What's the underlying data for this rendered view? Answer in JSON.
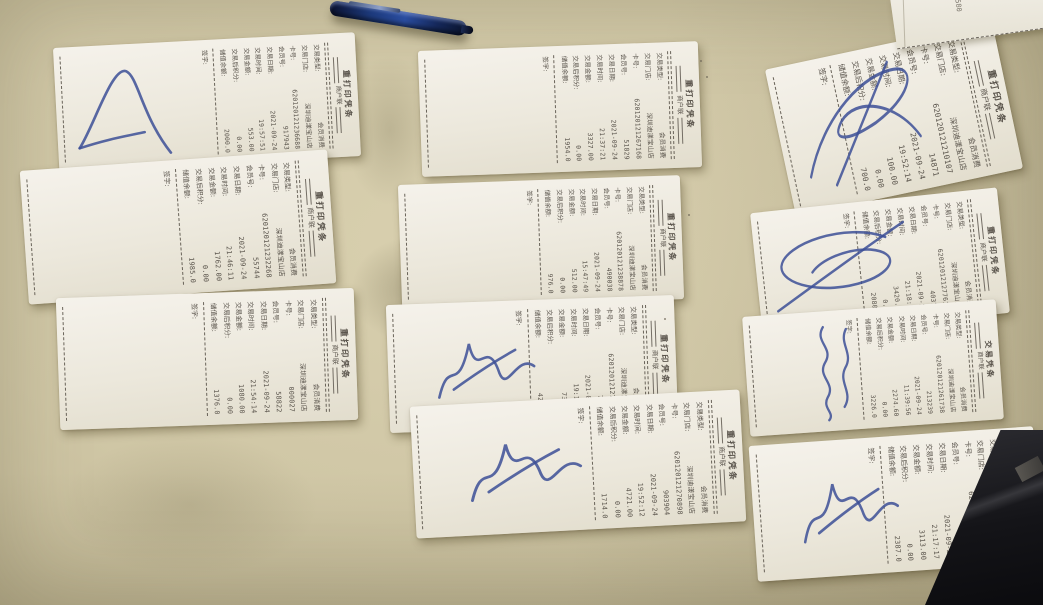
{
  "field_labels": [
    "交易类型:",
    "交易门店:",
    "卡号:",
    "会员号:",
    "交易日期:",
    "交易时间:",
    "交易金额:",
    "交易后积分:",
    "储值余额:"
  ],
  "sign_label": "签字:",
  "partial_receipt": {
    "text": "1580"
  },
  "colors": {
    "table": "#cfc6a5",
    "paper": "#f2efe7",
    "ink": "#4e4840",
    "pen_ink_blue": "#3c4f96",
    "pen_body_blue": "#1d3a7c",
    "dark_object": "#141418"
  },
  "receipts": [
    {
      "title": "重打印凭条",
      "copy_label": "商户联",
      "signature": "checkmark-scribble",
      "values": {
        "type": "会员消费",
        "store": "深圳迪漾宝山店",
        "card": "620120121236688",
        "member": "917943",
        "date": "2021-09-24",
        "time": "19:57:51",
        "amount": "553.00",
        "points": "0.00",
        "balance": "2000.0"
      }
    },
    {
      "title": "重打印凭条",
      "copy_label": "商户联",
      "signature": "none",
      "values": {
        "type": "会员消费",
        "store": "深圳迪漾宝山店",
        "card": "620120121267168",
        "member": "51829",
        "date": "2021-09-24",
        "time": "21:37:21",
        "amount": "3327.00",
        "points": "0.00",
        "balance": "1954.0"
      }
    },
    {
      "title": "重打印凭条",
      "copy_label": "商户联",
      "signature": "grand-loop-scribble",
      "values": {
        "type": "会员消费",
        "store": "深圳迪漾宝山店",
        "card": "620120121210107",
        "member": "14871",
        "date": "2021-09-24",
        "time": "19:52:14",
        "amount": "100.00",
        "points": "0.00",
        "balance": "700.0"
      }
    },
    {
      "title": "重打印凭条",
      "copy_label": "商户联",
      "signature": "none",
      "values": {
        "type": "会员消费",
        "store": "深圳迪漾宝山店",
        "card": "620120121232268",
        "member": "55744",
        "date": "2021-09-24",
        "time": "21:46:11",
        "amount": "1762.00",
        "points": "0.00",
        "balance": "1985.0"
      }
    },
    {
      "title": "重打印凭条",
      "copy_label": "商户联",
      "signature": "none",
      "values": {
        "type": "会员消费",
        "store": "深圳迪漾宝山店",
        "card": "620120121238878",
        "member": "490038",
        "date": "2021-09-24",
        "time": "15:47:49",
        "amount": "512.00",
        "points": "0.00",
        "balance": "976.0"
      }
    },
    {
      "title": "重打印凭条",
      "copy_label": "商户联",
      "signature": "oval-loop-scribble",
      "values": {
        "type": "会员消费",
        "store": "深圳迪漾宝山店",
        "card": "620120121277618",
        "member": "40379",
        "date": "2021-09-24",
        "time": "21:18:50",
        "amount": "3420.00",
        "points": "0.00",
        "balance": "2080.0"
      }
    },
    {
      "title": "重打印凭条",
      "copy_label": "商户联",
      "signature": "none",
      "values": {
        "type": "会员消费",
        "store": "深圳迪漾宝山店",
        "card": "000027",
        "member": "58822",
        "date": "2021-09-24",
        "time": "21:54:14",
        "amount": "1080.00",
        "points": "0.00",
        "balance": "1376.0"
      }
    },
    {
      "title": "重打印凭条",
      "copy_label": "商户联",
      "signature": "small-scrawl",
      "values": {
        "type": "会员消费",
        "store": "深圳迪漾宝山店",
        "card": "620120121277818",
        "member": "79969",
        "date": "2021-09-24",
        "time": "19:13:51",
        "amount": "735.00",
        "points": "0.00",
        "balance": "4277.0"
      }
    },
    {
      "title": "交易凭条",
      "copy_label": "商户联",
      "signature": "vertical-name",
      "values": {
        "type": "会员消费",
        "store": "深圳迪漾宝山店",
        "card": "620120121261738",
        "member": "213239",
        "date": "2021-09-24",
        "time": "11:39:56",
        "amount": "2274.60",
        "points": "0.00",
        "balance": "3226.0"
      }
    },
    {
      "title": "重打印凭条",
      "copy_label": "商户联",
      "signature": "small-scrawl",
      "values": {
        "type": "会员消费",
        "store": "深圳迪漾宝山店",
        "card": "620120121270898",
        "member": "903904",
        "date": "2021-09-24",
        "time": "19:52:12",
        "amount": "4721.00",
        "points": "0.00",
        "balance": "1714.0"
      }
    },
    {
      "title": "重打印凭条",
      "copy_label": "商户联",
      "signature": "small-scrawl",
      "values": {
        "type": "会员消费",
        "store": "深圳迪漾宝山店",
        "card": "620120121276158",
        "member": "39756",
        "date": "2021-09-24",
        "time": "21:17:17",
        "amount": "3113.00",
        "points": "0.00",
        "balance": "2387.0"
      }
    }
  ]
}
